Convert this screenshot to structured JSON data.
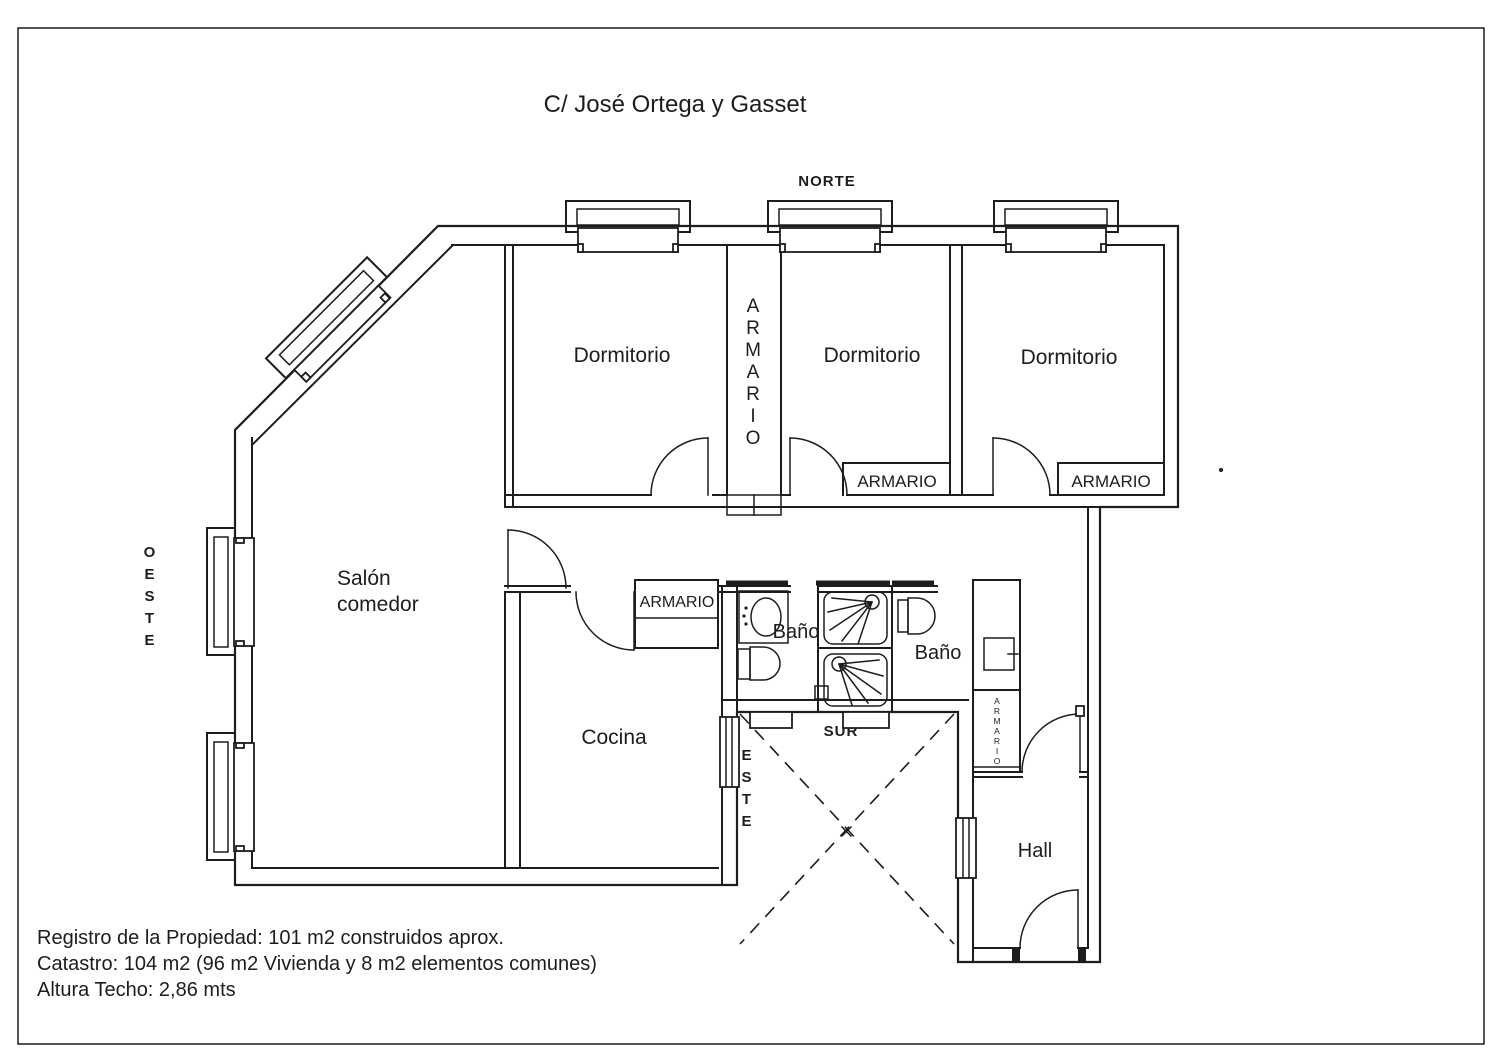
{
  "page": {
    "title": "C/ José Ortega y Gasset",
    "ink_color": "#1d1d1d",
    "background_color": "#ffffff"
  },
  "compass": {
    "north": "NORTE",
    "south": "SUR",
    "west_letters": [
      "O",
      "E",
      "S",
      "T",
      "E"
    ],
    "east_letters": [
      "E",
      "S",
      "T",
      "E"
    ]
  },
  "rooms": {
    "bedroom": "Dormitorio",
    "salon_line1": "Salón",
    "salon_line2": "comedor",
    "kitchen": "Cocina",
    "bath": "Baño",
    "hall": "Hall",
    "closet": "ARMARIO",
    "closet_letters": [
      "A",
      "R",
      "M",
      "A",
      "R",
      "I",
      "O"
    ]
  },
  "notes": {
    "line1": "Registro de la Propiedad: 101 m2 construidos aprox.",
    "line2": "Catastro: 104 m2 (96 m2 Vivienda y 8 m2 elementos comunes)",
    "line3": "Altura Techo: 2,86 mts"
  }
}
